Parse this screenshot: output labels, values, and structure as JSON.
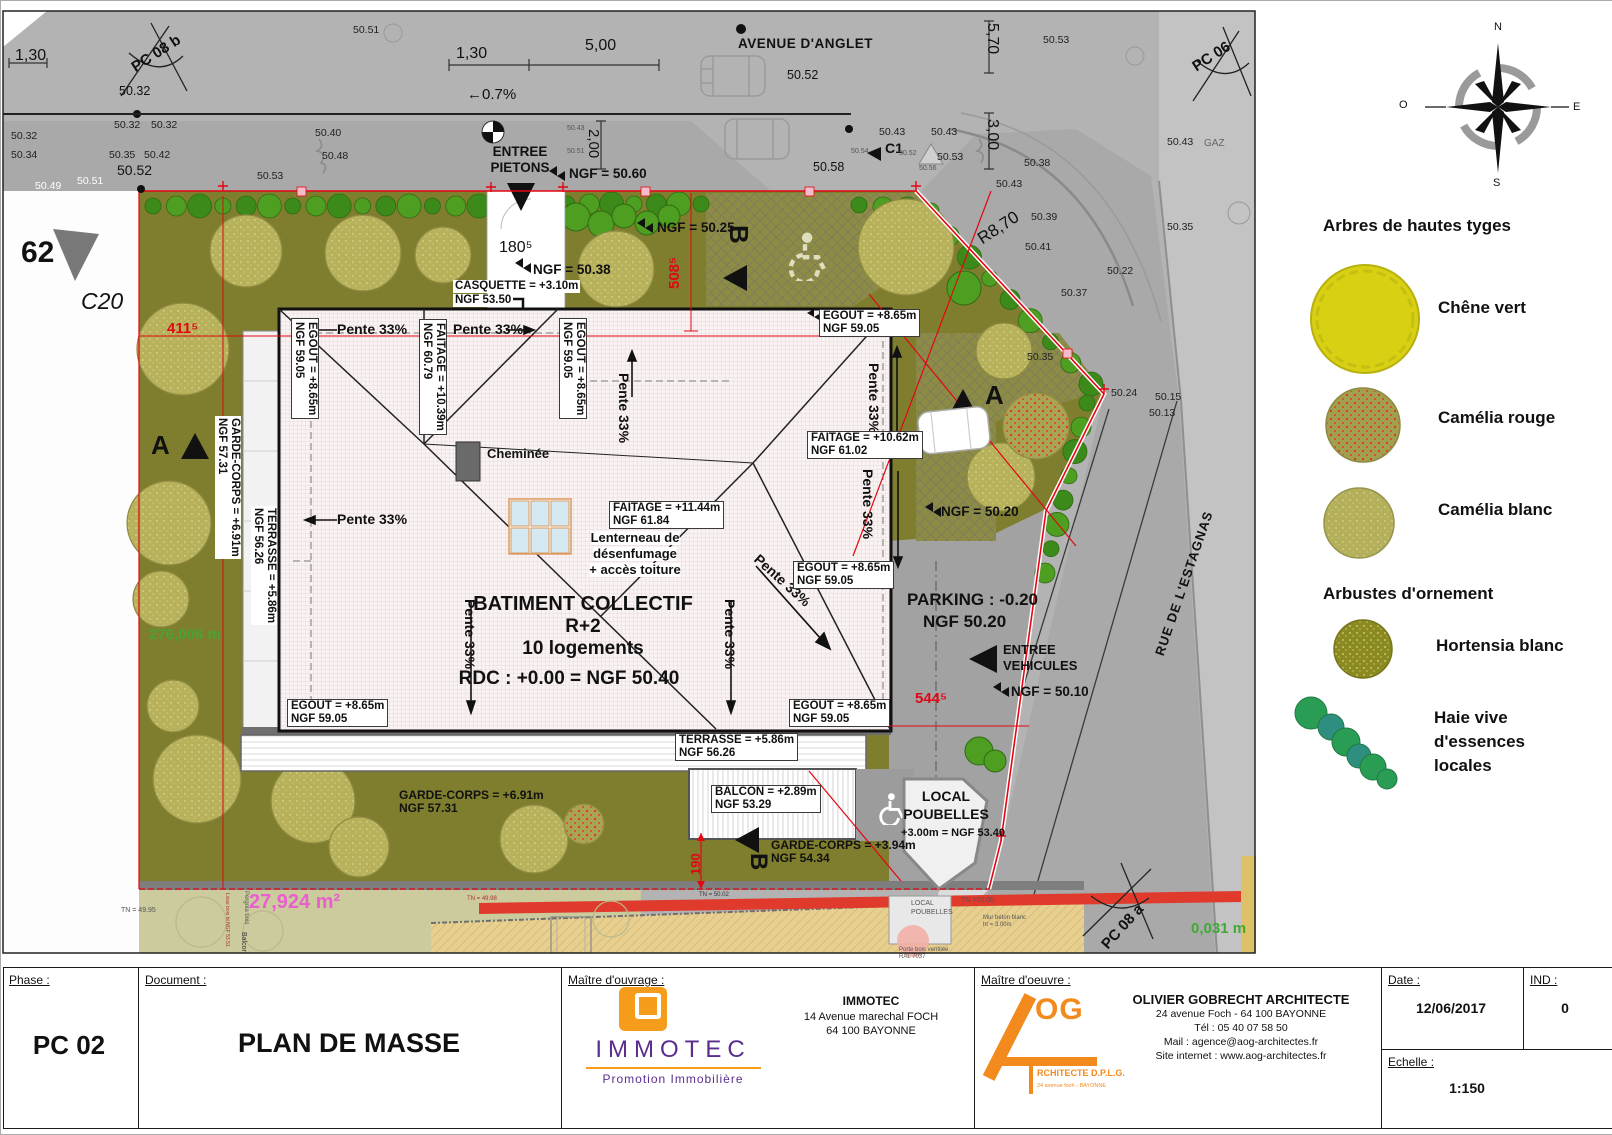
{
  "sheet": {
    "phase_label": "Phase :",
    "phase": "PC 02",
    "document_label": "Document :",
    "document": "PLAN DE MASSE",
    "mo_label": "Maître d'ouvrage :",
    "moe_label": "Maître d'oeuvre :",
    "date_label": "Date :",
    "date": "12/06/2017",
    "ind_label": "IND :",
    "ind": "0",
    "echelle_label": "Echelle :",
    "echelle": "1:150"
  },
  "ouvrage": {
    "logo": "IMMOTEC",
    "logo_sub": "Promotion Immobilière",
    "name": "IMMOTEC",
    "addr1": "14 Avenue marechal FOCH",
    "addr2": "64 100 BAYONNE"
  },
  "oeuvre": {
    "name": "OLIVIER GOBRECHT ARCHITECTE",
    "addr": "24 avenue Foch - 64 100 BAYONNE",
    "tel": "Tél : 05 40 07 58 50",
    "mail": "Mail : agence@aog-architectes.fr",
    "site": "Site internet : www.aog-architectes.fr",
    "logo_og": "OG",
    "logo_sub": "RCHITECTE D.P.L.G.",
    "logo_addr": "24 avenue foch - BAYONNE"
  },
  "legend": {
    "title1": "Arbres de hautes tyges",
    "item1": "Chêne vert",
    "item2": "Camélia rouge",
    "item3": "Camélia blanc",
    "title2": "Arbustes d'ornement",
    "item4": "Hortensia blanc",
    "item5a": "Haie vive",
    "item5b": "d'essences",
    "item5c": "locales"
  },
  "legend_colors": {
    "chene": "#d7d013",
    "camelia_rouge": "#a39f50",
    "camelia_dots": "#e03010",
    "camelia_blanc": "#b3af5b",
    "hortensia": "#8a8a20",
    "haie1": "#2a9d55",
    "haie2": "#2e8e7f"
  },
  "compass": {
    "n": "N",
    "s": "S",
    "e": "E",
    "o": "O"
  },
  "streets": {
    "avenue": "AVENUE D'ANGLET",
    "rue": "RUE DE L'ESTAGNAS",
    "gaz": "GAZ"
  },
  "markers": {
    "pc08b": "PC 08 b",
    "pc06": "PC 06",
    "pc08a": "PC 08 a",
    "c1": "C1",
    "c20": "C20",
    "n62": "62",
    "a": "A",
    "b": "B"
  },
  "dims": {
    "d130": "1,30",
    "d500": "5,00",
    "d200": "2,00",
    "d570": "5,70",
    "d300": "3,00",
    "r870": "R8,70",
    "slope": "←0.7%",
    "d180": "180⁵",
    "d411": "411⁵",
    "d508": "508⁵",
    "d544": "544⁵",
    "d190": "190"
  },
  "areas": {
    "a1": "276,006 m",
    "a2": "27,924 m²",
    "a3": "0,031 m"
  },
  "building": {
    "t1": "BATIMENT COLLECTIF",
    "t2": "R+2",
    "t3": "10 logements",
    "rdc": "RDC : +0.00 = NGF 50.40",
    "pente": "Pente 33%",
    "egout1": "EGOUT = +8.65m",
    "egout2": "NGF 59.05",
    "fait1a": "FAITAGE = +10.39m",
    "fait1b": "NGF 60.79",
    "fait2a": "FAITAGE = +10.62m",
    "fait2b": "NGF 61.02",
    "fait3a": "FAITAGE = +11.44m",
    "fait3b": "NGF 61.84",
    "terra": "TERRASSE = +5.86m",
    "terrb": "NGF 56.26",
    "gc1a": "GARDE-CORPS = +6.91m",
    "gc1b": "NGF 57.31",
    "gc2a": "GARDE-CORPS = +3.94m",
    "gc2b": "NGF 54.34",
    "balca": "BALCON = +2.89m",
    "balcb": "NGF 53.29",
    "casqa": "CASQUETTE = +3.10m",
    "casqb": "NGF 53.50",
    "chem": "Cheminée",
    "lant1": "Lenterneau de",
    "lant2": "désenfumage",
    "lant3": "+ accès toiture"
  },
  "site": {
    "entree1": "ENTREE",
    "entree2": "PIETONS",
    "entrev1": "ENTREE",
    "entrev2": "VEHICULES",
    "ngf5060": "NGF = 50.60",
    "ngf5025": "NGF = 50.25",
    "ngf5038": "NGF = 50.38",
    "ngf5020": "NGF = 50.20",
    "ngf5010": "NGF = 50.10",
    "parka": "PARKING : -0.20",
    "parkb": "NGF 50.20",
    "local1": "LOCAL",
    "local2": "POUBELLES",
    "local3": "+3.00m = NGF 53.40",
    "tn5000": "TN =50.00",
    "mur1": "Mur béton blanc",
    "mur2": "ht = 3.00m",
    "porte1": "Porte bois ventilée",
    "porte2": "RAL 7037",
    "tn4995": "TN = 49.95",
    "tn4998": "TN = 49.98",
    "tn5002": "TN = 50.02",
    "pergola": "Pergola bois",
    "balcon": "Balcon",
    "lisse": "Lisse bois ht NGF 53.51"
  },
  "spot_elevations": [
    {
      "v": "50.51",
      "x": 352,
      "y": 24,
      "c": "f10"
    },
    {
      "v": "50.32",
      "x": 118,
      "y": 84,
      "c": "f12"
    },
    {
      "v": "50.32",
      "x": 113,
      "y": 119,
      "c": "f10"
    },
    {
      "v": "50.32",
      "x": 150,
      "y": 119,
      "c": "f10"
    },
    {
      "v": "50.32",
      "x": 10,
      "y": 130,
      "c": "f10"
    },
    {
      "v": "50.34",
      "x": 10,
      "y": 149,
      "c": "f10"
    },
    {
      "v": "50.35",
      "x": 108,
      "y": 149,
      "c": "f10"
    },
    {
      "v": "50.42",
      "x": 143,
      "y": 149,
      "c": "f10"
    },
    {
      "v": "50.40",
      "x": 314,
      "y": 127,
      "c": "f10"
    },
    {
      "v": "50.48",
      "x": 321,
      "y": 150,
      "c": "f10"
    },
    {
      "v": "50.52",
      "x": 116,
      "y": 162,
      "c": "f14 n"
    },
    {
      "v": "50.49",
      "x": 34,
      "y": 180,
      "c": "f10 wht"
    },
    {
      "v": "50.51",
      "x": 76,
      "y": 175,
      "c": "f10 wht"
    },
    {
      "v": "50.53",
      "x": 256,
      "y": 170,
      "c": "f10"
    },
    {
      "v": "50.52",
      "x": 786,
      "y": 68,
      "c": "f12"
    },
    {
      "v": "50.43",
      "x": 566,
      "y": 124,
      "c": "tiny"
    },
    {
      "v": "50.51",
      "x": 566,
      "y": 147,
      "c": "tiny"
    },
    {
      "v": "50.58",
      "x": 812,
      "y": 160,
      "c": "f12"
    },
    {
      "v": "50.43",
      "x": 878,
      "y": 126,
      "c": "f10"
    },
    {
      "v": "50.43",
      "x": 930,
      "y": 126,
      "c": "f10"
    },
    {
      "v": "50.54",
      "x": 850,
      "y": 147,
      "c": "tiny"
    },
    {
      "v": "50.52",
      "x": 898,
      "y": 149,
      "c": "tiny"
    },
    {
      "v": "50.53",
      "x": 936,
      "y": 151,
      "c": "f10"
    },
    {
      "v": "50.56",
      "x": 918,
      "y": 164,
      "c": "tiny wht"
    },
    {
      "v": "50.43",
      "x": 995,
      "y": 178,
      "c": "f10"
    },
    {
      "v": "50.38",
      "x": 1023,
      "y": 157,
      "c": "f10"
    },
    {
      "v": "50.53",
      "x": 1042,
      "y": 34,
      "c": "f10"
    },
    {
      "v": "50.43",
      "x": 1166,
      "y": 136,
      "c": "f10"
    },
    {
      "v": "50.39",
      "x": 1030,
      "y": 211,
      "c": "f10"
    },
    {
      "v": "50.41",
      "x": 1024,
      "y": 241,
      "c": "f10"
    },
    {
      "v": "50.22",
      "x": 1106,
      "y": 265,
      "c": "f10"
    },
    {
      "v": "50.37",
      "x": 1060,
      "y": 287,
      "c": "f10"
    },
    {
      "v": "50.35",
      "x": 1166,
      "y": 221,
      "c": "f10"
    },
    {
      "v": "50.35",
      "x": 1026,
      "y": 351,
      "c": "f10"
    },
    {
      "v": "50.24",
      "x": 1110,
      "y": 387,
      "c": "f10"
    },
    {
      "v": "50.15",
      "x": 1154,
      "y": 391,
      "c": "f10"
    },
    {
      "v": "50.13",
      "x": 1148,
      "y": 407,
      "c": "f10"
    }
  ]
}
